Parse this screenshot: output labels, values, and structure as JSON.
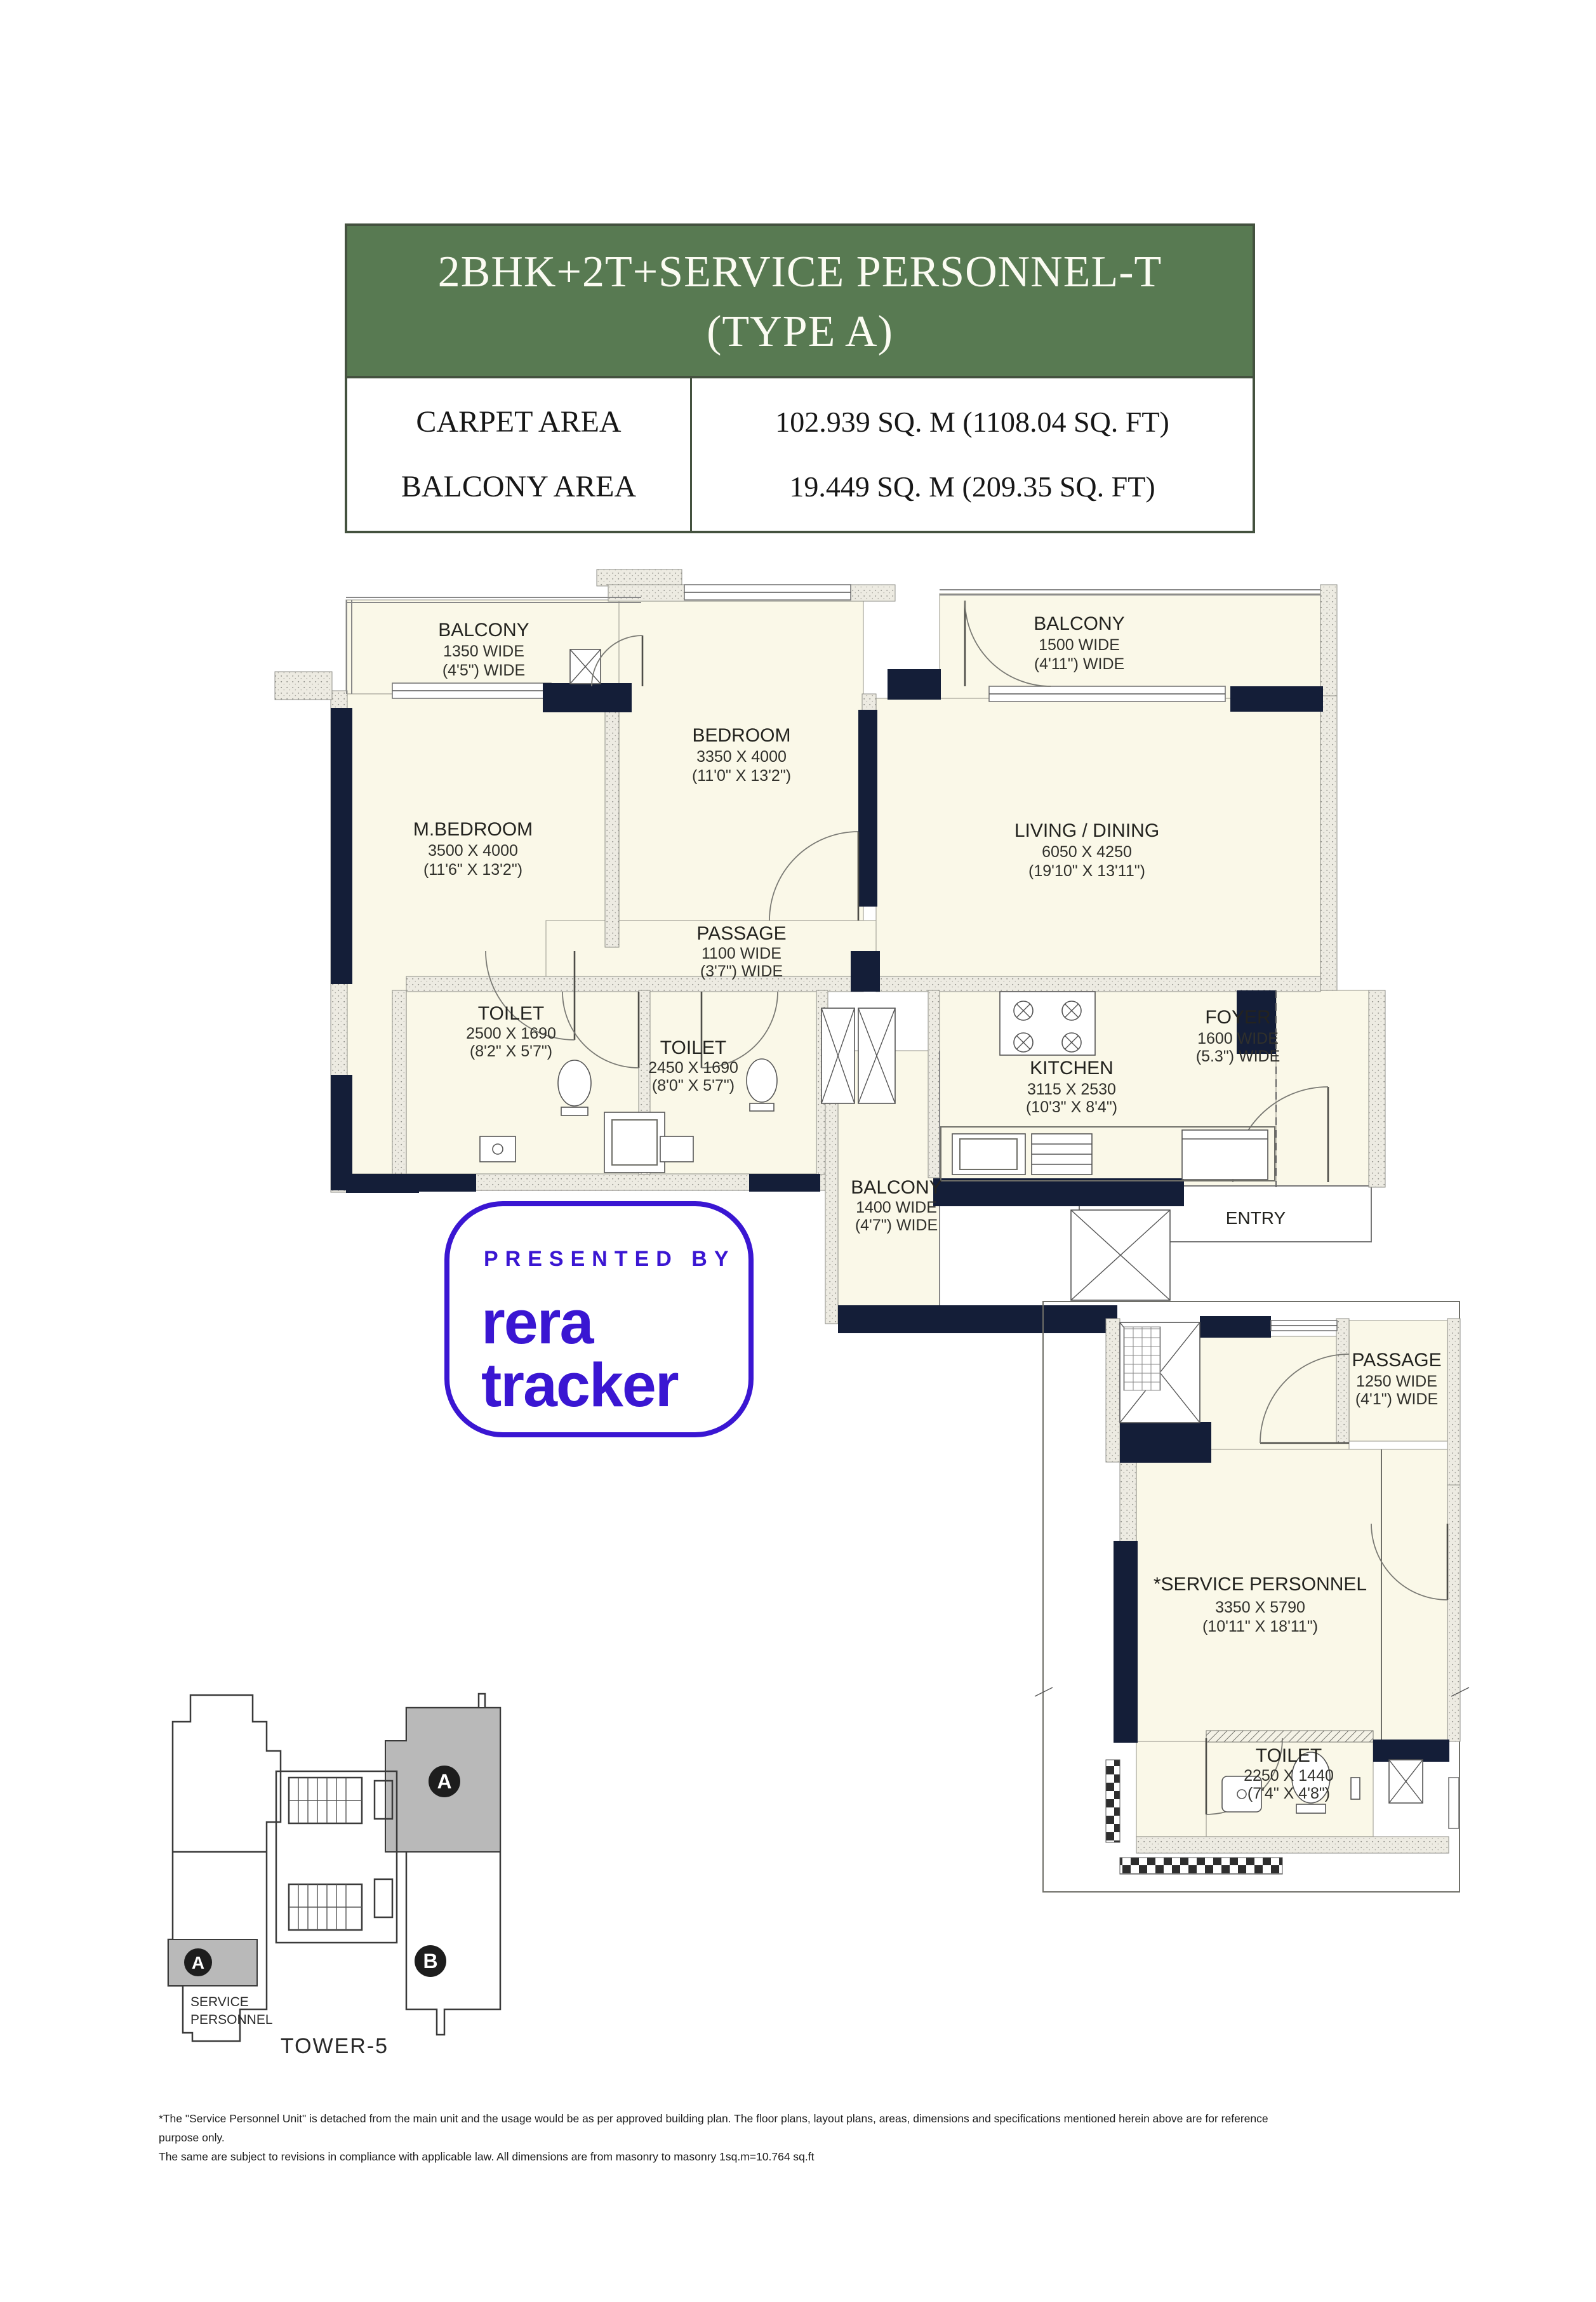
{
  "colors": {
    "header_green": "#587a52",
    "wall_navy": "#141e38",
    "room_cream": "#faf8e8",
    "brand_purple": "#3a16d2",
    "tower_gray": "#b9b9b9"
  },
  "header": {
    "title_line1": "2BHK+2T+SERVICE PERSONNEL-T",
    "title_line2": "(TYPE A)",
    "rows": [
      {
        "label": "CARPET AREA",
        "value": "102.939 SQ. M (1108.04 SQ. FT)"
      },
      {
        "label": "BALCONY AREA",
        "value": "19.449 SQ. M (209.35 SQ. FT)"
      }
    ]
  },
  "logo": {
    "presented_by": "PRESENTED BY",
    "brand_line1": "rera",
    "brand_line2": "tracker"
  },
  "main_plan": {
    "rooms": [
      {
        "name": "BALCONY",
        "l1": "1350 WIDE",
        "l2": "(4'5\") WIDE"
      },
      {
        "name": "BEDROOM",
        "l1": "3350 X 4000",
        "l2": "(11'0\" X 13'2\")"
      },
      {
        "name": "BALCONY",
        "l1": "1500 WIDE",
        "l2": "(4'11\") WIDE"
      },
      {
        "name": "M.BEDROOM",
        "l1": "3500 X 4000",
        "l2": "(11'6\" X 13'2\")"
      },
      {
        "name": "LIVING / DINING",
        "l1": "6050 X 4250",
        "l2": "(19'10\" X 13'11\")"
      },
      {
        "name": "PASSAGE",
        "l1": "1100 WIDE",
        "l2": "(3'7\") WIDE"
      },
      {
        "name": "TOILET",
        "l1": "2500 X 1690",
        "l2": "(8'2\" X 5'7\")"
      },
      {
        "name": "TOILET",
        "l1": "2450 X 1690",
        "l2": "(8'0\" X 5'7\")"
      },
      {
        "name": "KITCHEN",
        "l1": "3115 X 2530",
        "l2": "(10'3\" X 8'4\")"
      },
      {
        "name": "FOYER",
        "l1": "1600 WIDE",
        "l2": "(5.3\") WIDE"
      },
      {
        "name": "BALCONY",
        "l1": "1400 WIDE",
        "l2": "(4'7\") WIDE"
      }
    ],
    "entry_label": "ENTRY"
  },
  "service_plan": {
    "rooms": [
      {
        "name": "PASSAGE",
        "l1": "1250 WIDE",
        "l2": "(4'1\") WIDE"
      },
      {
        "name": "*SERVICE PERSONNEL",
        "l1": "3350 X 5790",
        "l2": "(10'11\" X 18'11\")"
      },
      {
        "name": "TOILET",
        "l1": "2250 X 1440",
        "l2": "(7'4\" X 4'8\")"
      }
    ]
  },
  "tower": {
    "label": "TOWER-5",
    "unit_a": "A",
    "unit_b": "B",
    "service_line1": "SERVICE",
    "service_line2": "PERSONNEL"
  },
  "disclaimer": {
    "line1": "*The \"Service Personnel Unit\" is detached from the main unit and the usage would be as per approved building plan. The floor plans, layout plans, areas, dimensions and specifications mentioned herein above are for reference purpose only.",
    "line2": "The same are subject to revisions in compliance with applicable law. All dimensions are from masonry to masonry 1sq.m=10.764 sq.ft"
  }
}
